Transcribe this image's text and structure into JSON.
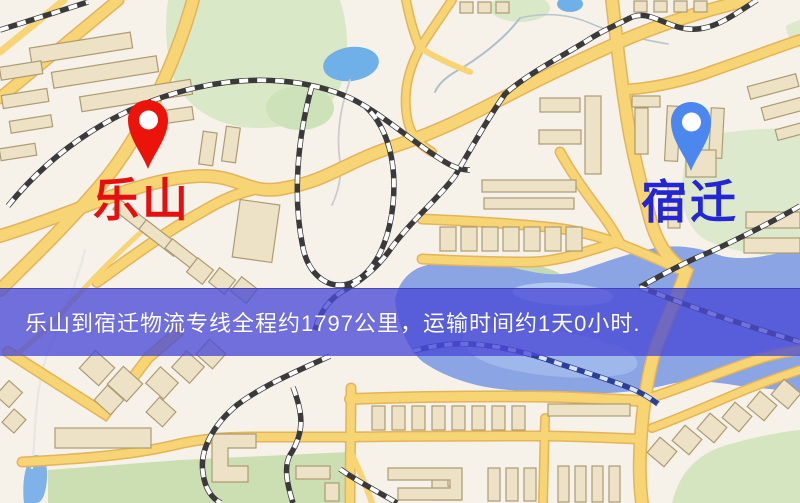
{
  "map": {
    "origin": {
      "name": "乐山",
      "pin_color": "#ec130b",
      "label_color": "#e60f0f"
    },
    "destination": {
      "name": "宿迁",
      "pin_color": "#4c86ef",
      "label_color": "#2326d6"
    },
    "banner": {
      "text": "乐山到宿迁物流专线全程约1797公里，运输时间约1天0小时.",
      "background_color": "#4a4ad6",
      "text_color": "#ffffff",
      "distance_km": "1797",
      "transit_time": "1天0小时"
    },
    "style_colors": {
      "land": "#f6f2ea",
      "road": "#f7d474",
      "road_casing": "#e3b45a",
      "water": "#8aa4e4",
      "park": "#d9e8c6",
      "building": "#ede2c6",
      "railway_dark": "#3a3a3a",
      "railway_water": "#2b3e98"
    }
  }
}
